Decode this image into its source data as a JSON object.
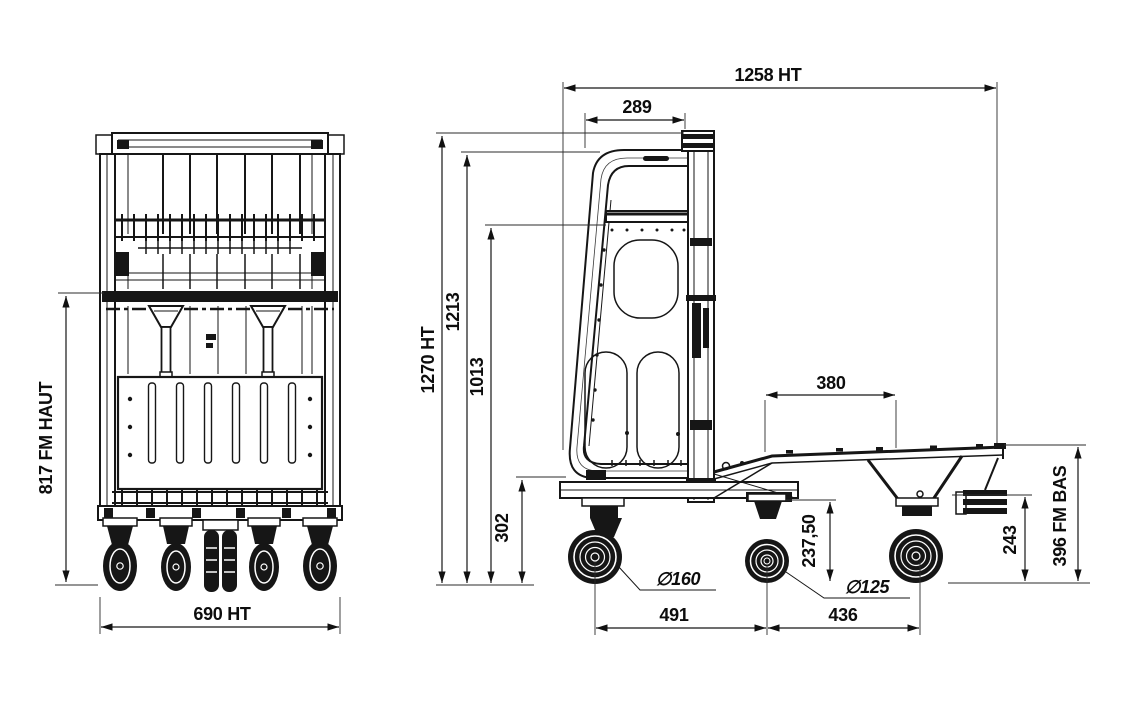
{
  "colors": {
    "line": "#161616",
    "background": "#ffffff"
  },
  "drawing": {
    "front_view": {
      "dim_fm_haut": "817 FM HAUT",
      "dim_overall_width": "690 HT"
    },
    "side_view": {
      "dim_overall_length": "1258 HT",
      "dim_handle_to_mast": "289",
      "dim_overall_height": "1270 HT",
      "dim_handle_height": "1213",
      "dim_backrest_height": "1013",
      "dim_step_height": "302",
      "dim_platform_length": "380",
      "dim_underframe_height": "237,50",
      "dim_front_wheel_diameter": "∅160",
      "dim_mid_wheel_diameter": "∅125",
      "dim_front_wheelbase": "491",
      "dim_rear_wheelbase": "436",
      "dim_rear_clearance": "243",
      "dim_fm_bas": "396 FM BAS"
    }
  }
}
